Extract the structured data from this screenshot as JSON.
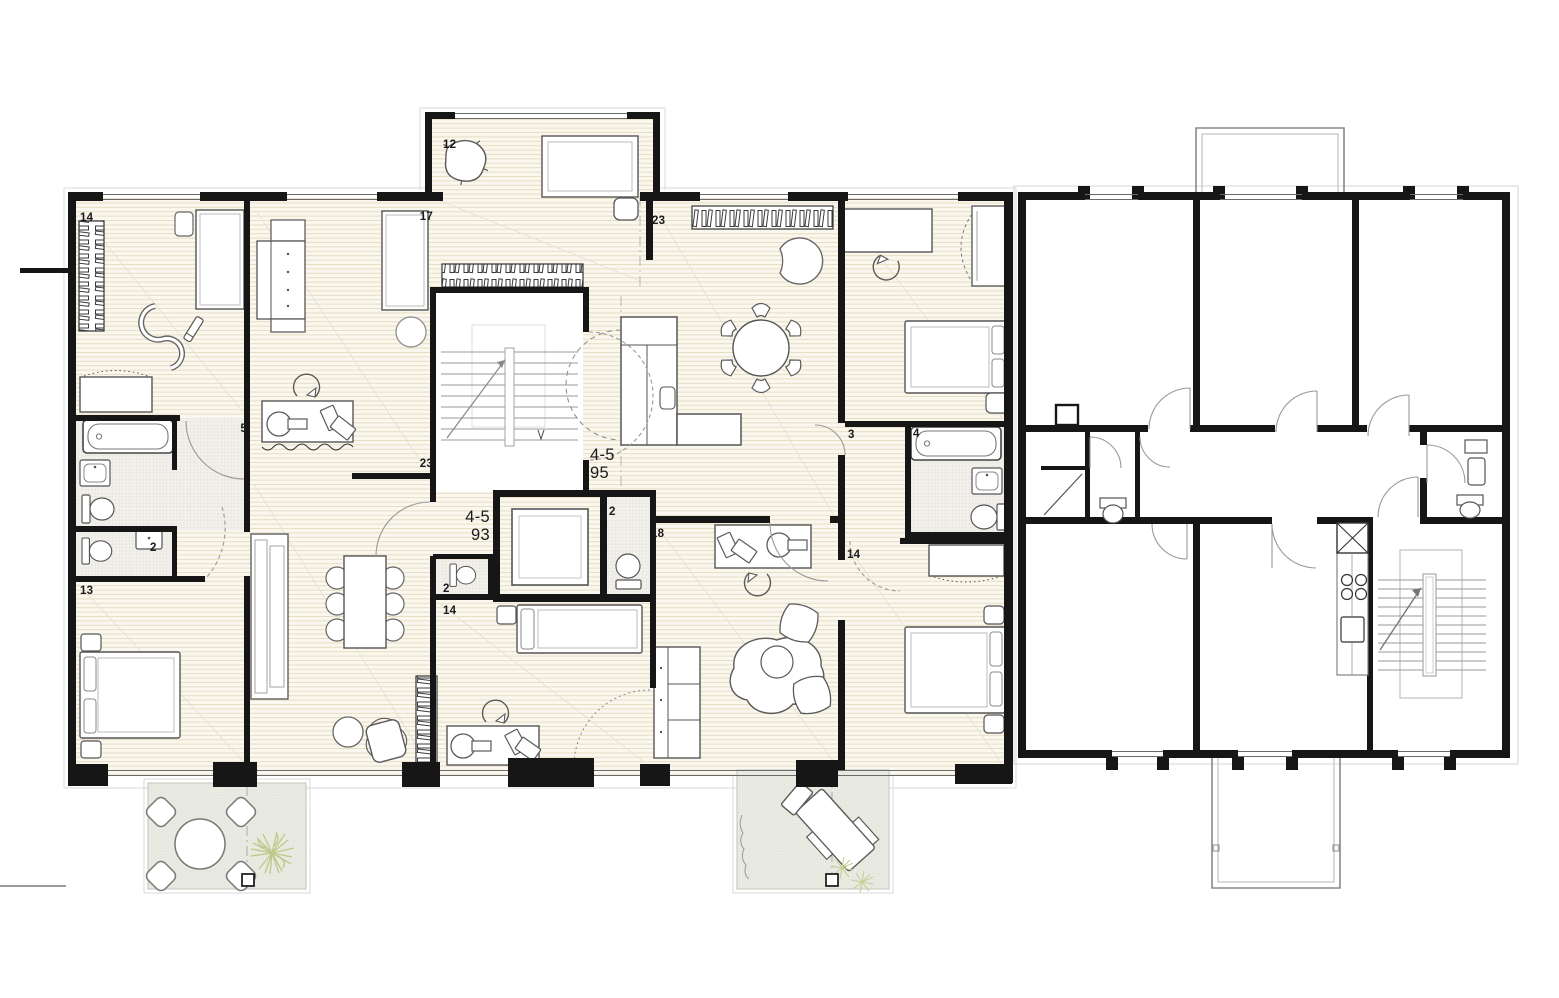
{
  "page": {
    "background": "#ffffff",
    "description": "architectural floor plan drawing, furnished attic plan left and existing unfurnished plan right"
  },
  "colors": {
    "wall": "#161616",
    "wood_floor": "#faf7ee",
    "wood_line": "#e7ddc4",
    "tile_floor": "#f3f1ec",
    "tile_line": "#dbd7cd",
    "terrace_floor": "#eaebe3",
    "terrace_line": "#dde0d2",
    "furniture_stroke": "#5a5a5a",
    "plant_green": "#bcc98a",
    "label_color": "#1a1a1a"
  },
  "left_plan": {
    "name": "attic-floor-plan-furnished",
    "apartment_labels": [
      {
        "line1": "4-5",
        "line2": "95",
        "desc": "apartment-right"
      },
      {
        "line1": "4-5",
        "line2": "93",
        "desc": "apartment-left"
      }
    ],
    "room_labels": [
      {
        "text": "14",
        "desc": "bedroom-top-left"
      },
      {
        "text": "17",
        "desc": "room-17"
      },
      {
        "text": "12",
        "desc": "bay-room"
      },
      {
        "text": "23",
        "desc": "living-room-right"
      },
      {
        "text": "6",
        "desc": "hall"
      },
      {
        "text": "5",
        "desc": "bathroom-left"
      },
      {
        "text": "23",
        "desc": "living-room-left"
      },
      {
        "text": "2",
        "desc": "wc-right"
      },
      {
        "text": "18",
        "desc": "study-room-right"
      },
      {
        "text": "2",
        "desc": "wc-mid"
      },
      {
        "text": "14",
        "desc": "bedroom-bottom-mid"
      },
      {
        "text": "2",
        "desc": "wc-left"
      },
      {
        "text": "13",
        "desc": "bedroom-bottom-left"
      },
      {
        "text": "3",
        "desc": "bedroom-top-right"
      },
      {
        "text": "4",
        "desc": "bathroom-right"
      },
      {
        "text": "14",
        "desc": "bedroom-bottom-right"
      }
    ]
  },
  "right_plan": {
    "name": "existing-floor-plan-unfurnished"
  }
}
